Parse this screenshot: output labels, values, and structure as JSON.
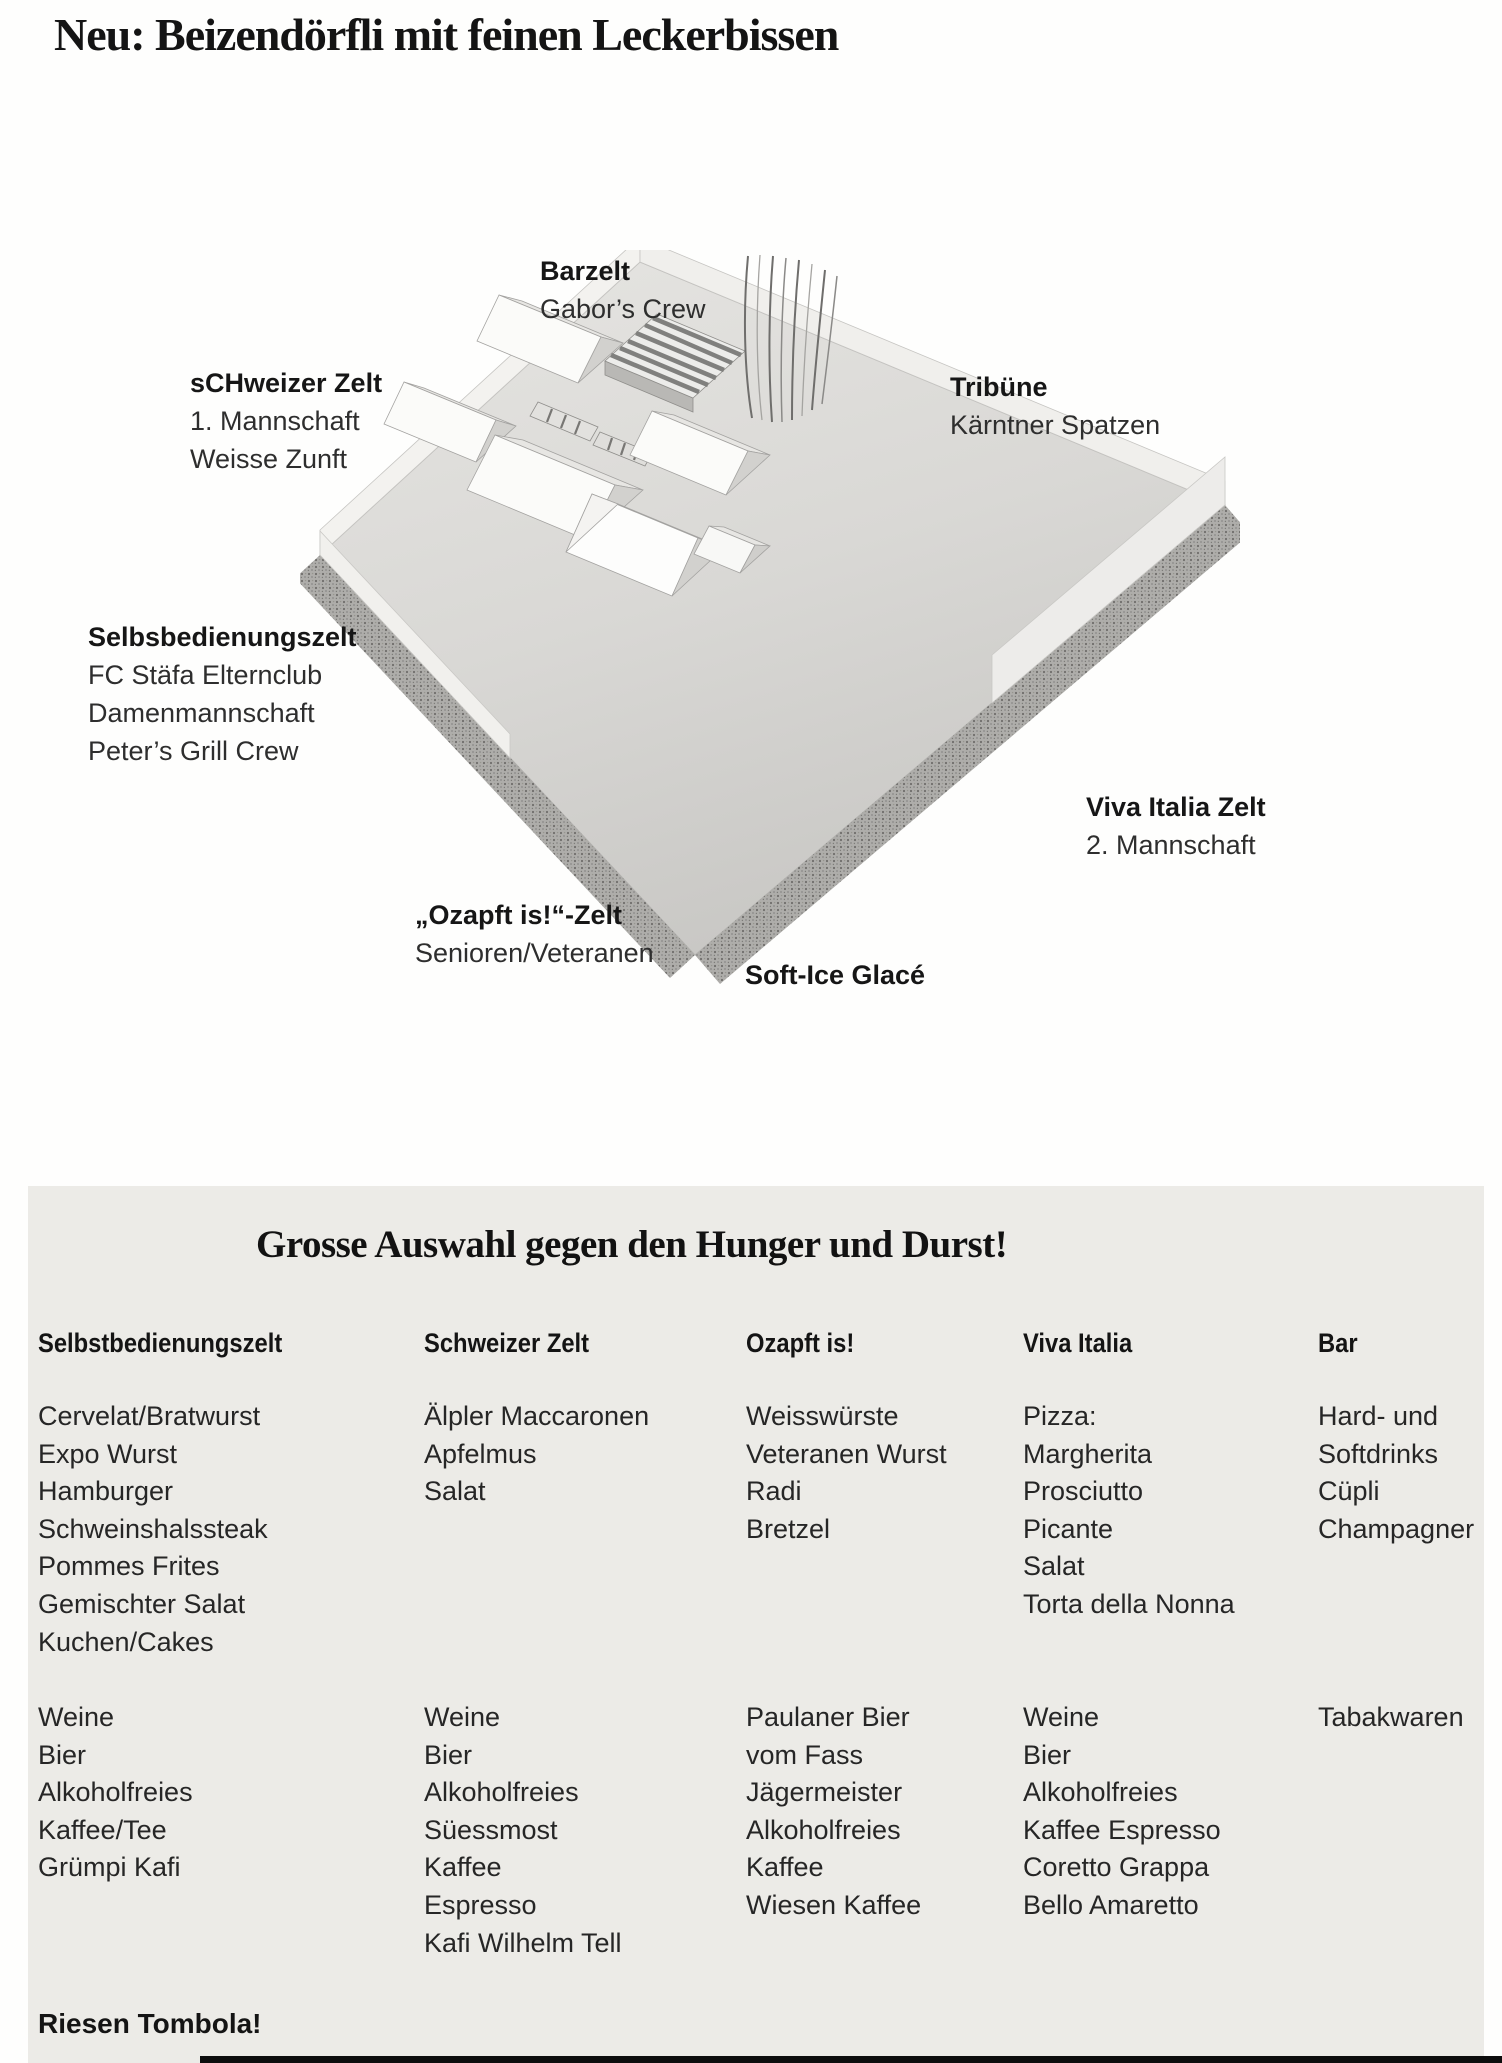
{
  "page": {
    "title": "Neu: Beizendörfli mit feinen Leckerbissen"
  },
  "map": {
    "labels": {
      "barzelt": {
        "title": "Barzelt",
        "lines": [
          "Gabor’s Crew"
        ]
      },
      "schweizer": {
        "title": "sCHweizer Zelt",
        "lines": [
          "1. Mannschaft",
          "Weisse Zunft"
        ]
      },
      "tribuene": {
        "title": "Tribüne",
        "lines": [
          "Kärntner Spatzen"
        ]
      },
      "selbst": {
        "title": "Selbsbedienungszelt",
        "lines": [
          "FC Stäfa Elternclub",
          "Damenmannschaft",
          "Peter’s Grill Crew"
        ]
      },
      "viva": {
        "title": "Viva Italia Zelt",
        "lines": [
          "2. Mannschaft"
        ]
      },
      "ozapft": {
        "title": "„Ozapft is!“-Zelt",
        "lines": [
          "Senioren/Veteranen"
        ]
      },
      "softice": {
        "title": "Soft-Ice Glacé",
        "lines": []
      }
    }
  },
  "menu": {
    "heading": "Grosse Auswahl gegen den Hunger und Durst!",
    "columns": [
      {
        "header": "Selbstbedienungszelt",
        "food": [
          "Cervelat/Bratwurst",
          "Expo Wurst",
          "Hamburger",
          "Schweinshalssteak",
          "Pommes Frites",
          "Gemischter Salat",
          "Kuchen/Cakes"
        ],
        "drinks": [
          "Weine",
          "Bier",
          "Alkoholfreies",
          "Kaffee/Tee",
          "Grümpi Kafi"
        ]
      },
      {
        "header": "Schweizer Zelt",
        "food": [
          "Älpler Maccaronen",
          "Apfelmus",
          "Salat"
        ],
        "drinks": [
          "Weine",
          "Bier",
          "Alkoholfreies",
          "Süessmost",
          "Kaffee",
          "Espresso",
          "Kafi Wilhelm Tell"
        ]
      },
      {
        "header": "Ozapft is!",
        "food": [
          "Weisswürste",
          "Veteranen Wurst",
          "Radi",
          "Bretzel"
        ],
        "drinks": [
          "Paulaner Bier",
          "vom Fass",
          "Jägermeister",
          "Alkoholfreies",
          "Kaffee",
          "Wiesen Kaffee"
        ]
      },
      {
        "header": "Viva Italia",
        "food": [
          "Pizza:",
          "Margherita",
          "Prosciutto",
          "Picante",
          "Salat",
          "Torta della Nonna"
        ],
        "drinks": [
          "Weine",
          "Bier",
          "Alkoholfreies",
          "Kaffee Espresso",
          "Coretto Grappa",
          "Bello Amaretto"
        ]
      },
      {
        "header": "Bar",
        "food": [
          "Hard- und",
          "Softdrinks",
          "Cüpli",
          "Champagner"
        ],
        "drinks": [
          "Tabakwaren"
        ]
      }
    ],
    "footer": "Riesen Tombola!"
  }
}
